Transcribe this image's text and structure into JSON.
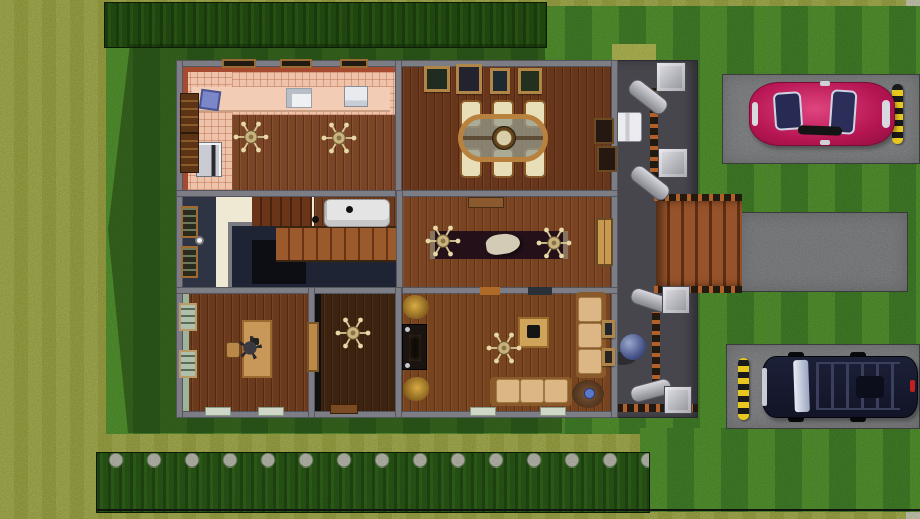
{
  "scene": {
    "name": "sims-style-overhead-house-lot",
    "view": "top-down floor plan of a suburban house with deck, driveways and two parked cars"
  },
  "palette": {
    "grass_base": "#a8b14b",
    "lawn_light": "#579a31",
    "lawn_dark": "#44842a",
    "hedge_green": "#265312",
    "stone_hedge_green": "#2b5c17",
    "sidewalk": "#d2d3b8",
    "driveway": "#8f9092",
    "concrete_path": "#8a8b8d",
    "deck_gray": "#46464c",
    "stair_wood": "#8a4a24",
    "wall_gray": "#7d7d85",
    "kitchen_tile": "#eec3aa",
    "kitchen_wall_red": "#a64a30",
    "wood_light": "#7a4526",
    "wood_dining": "#68361b",
    "wood_entry": "#7a4423",
    "wood_office": "#6b3a1d",
    "wood_dark_room": "#3c2310",
    "wood_living": "#77441f",
    "cream_floor": "#efe8d2",
    "navy_wall": "#2e3444",
    "stairwell_void": "#1e2433",
    "void_inner": "#0c0e14",
    "sage_wall": "#9db39a",
    "black_wall": "#101010",
    "rug_dark": "#241018",
    "sofa_tan": "#dcb684",
    "loveseat_white": "#e4e4e4",
    "door_wood": "#c89a50",
    "car_red": "#c2185b",
    "car_navy": "#171a2e",
    "caution_yellow": "#e8c81e",
    "counter_pink": "#f2ccb4",
    "desk_wood": "#c89858",
    "sphere_blue": "#6a7ab0"
  },
  "landscape": {
    "features": [
      "striped-mowed-lawn",
      "top-hedge-row",
      "stone-topped-hedge-row",
      "lot-boundary-line",
      "house-shadow",
      "sidewalk-strip",
      "upper-driveway",
      "lower-driveway",
      "concrete-walkway",
      "parking-stop-upper",
      "parking-stop-lower",
      "light-grass-patch"
    ]
  },
  "vehicles": [
    {
      "name": "red-sports-car",
      "color": "#c2185b",
      "location": "upper driveway"
    },
    {
      "name": "navy-suv",
      "color": "#171a2e",
      "location": "lower driveway"
    }
  ],
  "exterior": {
    "deck": [
      "white-bench",
      "blue-sphere-decor",
      "porch-column x4",
      "deck-railings",
      "wood-steps-to-path"
    ]
  },
  "rooms": [
    {
      "name": "kitchen",
      "furniture": [
        "counter-run",
        "blue-recycling-bin",
        "sink",
        "dishwasher",
        "stove",
        "bookshelf x2",
        "window x3",
        "ceiling-fan x2"
      ]
    },
    {
      "name": "dining-room",
      "furniture": [
        "oval-glass-dining-table",
        "upholstered-chair x6",
        "centerpiece-clock",
        "wall-art x4",
        "hutch x2"
      ]
    },
    {
      "name": "entry-hall",
      "furniture": [
        "runner-rug",
        "sculpture",
        "console-table",
        "ceiling-fan x2",
        "double-front-door"
      ]
    },
    {
      "name": "stair-hall",
      "furniture": [
        "navy-alcove-bookcase x2",
        "floor-lamp",
        "upper-stair-flight",
        "main-wide-staircase",
        "stairwell-void",
        "white-loveseat"
      ]
    },
    {
      "name": "office",
      "furniture": [
        "desk",
        "office-chair",
        "stool",
        "sage-window x2",
        "window-sill x2"
      ]
    },
    {
      "name": "dark-floor-room",
      "furniture": [
        "wood-door",
        "ceiling-fan",
        "floor-mat"
      ]
    },
    {
      "name": "living-room",
      "furniture": [
        "autumn-plant x2",
        "fireplace",
        "coffee-table",
        "ceiling-fan",
        "three-seat-sofa",
        "side-sofa",
        "round-rug",
        "blue-cushion",
        "wall-art x2"
      ]
    }
  ]
}
